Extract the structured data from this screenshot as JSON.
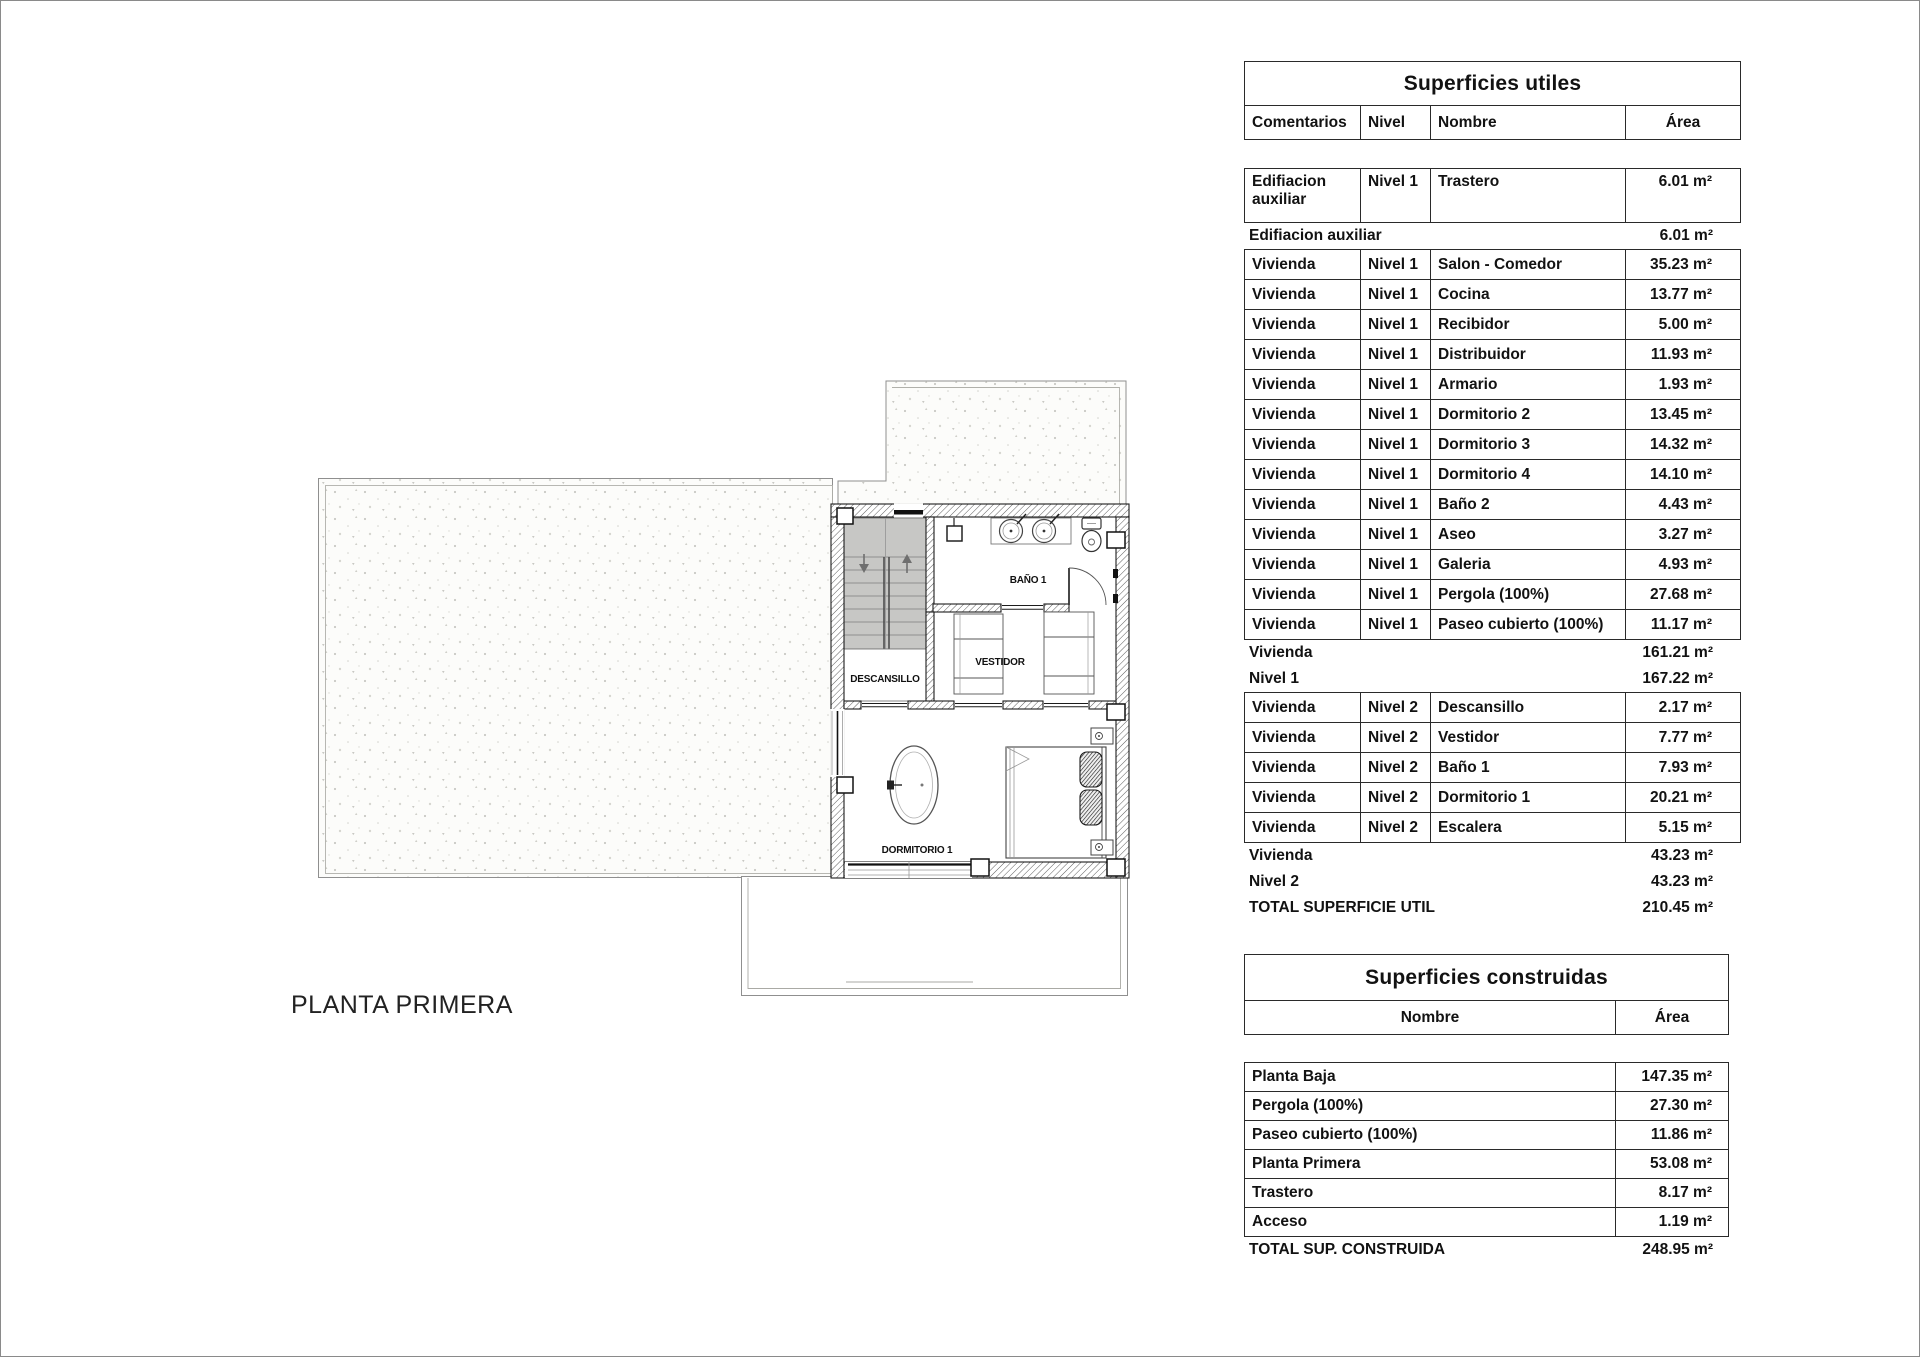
{
  "plan": {
    "caption": "PLANTA PRIMERA",
    "labels": {
      "landing": "DESCANSILLO",
      "dressing": "VESTIDOR",
      "bathroom": "BAÑO 1",
      "bedroom": "DORMITORIO 1"
    },
    "icons": {
      "stairs_down": "down-arrow",
      "stairs_up": "up-arrow"
    }
  },
  "tables": {
    "utiles": {
      "title": "Superficies utiles",
      "headers": [
        "Comentarios",
        "Nivel",
        "Nombre",
        "Área"
      ],
      "rows": [
        {
          "type": "data",
          "tall": true,
          "comentarios": "Edifiacion auxiliar",
          "nivel": "Nivel 1",
          "nombre": "Trastero",
          "area": "6.01 m²"
        },
        {
          "type": "subtotal",
          "label": "Edifiacion auxiliar",
          "area": "6.01 m²"
        },
        {
          "type": "data",
          "comentarios": "Vivienda",
          "nivel": "Nivel 1",
          "nombre": "Salon - Comedor",
          "area": "35.23 m²"
        },
        {
          "type": "data",
          "comentarios": "Vivienda",
          "nivel": "Nivel 1",
          "nombre": "Cocina",
          "area": "13.77 m²"
        },
        {
          "type": "data",
          "comentarios": "Vivienda",
          "nivel": "Nivel 1",
          "nombre": "Recibidor",
          "area": "5.00 m²"
        },
        {
          "type": "data",
          "comentarios": "Vivienda",
          "nivel": "Nivel 1",
          "nombre": "Distribuidor",
          "area": "11.93 m²"
        },
        {
          "type": "data",
          "comentarios": "Vivienda",
          "nivel": "Nivel 1",
          "nombre": "Armario",
          "area": "1.93 m²"
        },
        {
          "type": "data",
          "comentarios": "Vivienda",
          "nivel": "Nivel 1",
          "nombre": "Dormitorio 2",
          "area": "13.45 m²"
        },
        {
          "type": "data",
          "comentarios": "Vivienda",
          "nivel": "Nivel 1",
          "nombre": "Dormitorio 3",
          "area": "14.32 m²"
        },
        {
          "type": "data",
          "comentarios": "Vivienda",
          "nivel": "Nivel 1",
          "nombre": "Dormitorio 4",
          "area": "14.10 m²"
        },
        {
          "type": "data",
          "comentarios": "Vivienda",
          "nivel": "Nivel 1",
          "nombre": "Baño 2",
          "area": "4.43 m²"
        },
        {
          "type": "data",
          "comentarios": "Vivienda",
          "nivel": "Nivel 1",
          "nombre": "Aseo",
          "area": "3.27 m²"
        },
        {
          "type": "data",
          "comentarios": "Vivienda",
          "nivel": "Nivel 1",
          "nombre": "Galeria",
          "area": "4.93 m²"
        },
        {
          "type": "data",
          "comentarios": "Vivienda",
          "nivel": "Nivel 1",
          "nombre": "Pergola (100%)",
          "area": "27.68 m²"
        },
        {
          "type": "data",
          "comentarios": "Vivienda",
          "nivel": "Nivel 1",
          "nombre": "Paseo cubierto (100%)",
          "area": "11.17 m²"
        },
        {
          "type": "subtotal",
          "label": "Vivienda",
          "area": "161.21 m²"
        },
        {
          "type": "subtotal",
          "label": "Nivel 1",
          "area": "167.22 m²"
        },
        {
          "type": "data",
          "comentarios": "Vivienda",
          "nivel": "Nivel 2",
          "nombre": "Descansillo",
          "area": "2.17 m²"
        },
        {
          "type": "data",
          "comentarios": "Vivienda",
          "nivel": "Nivel 2",
          "nombre": "Vestidor",
          "area": "7.77 m²"
        },
        {
          "type": "data",
          "comentarios": "Vivienda",
          "nivel": "Nivel 2",
          "nombre": "Baño 1",
          "area": "7.93 m²"
        },
        {
          "type": "data",
          "comentarios": "Vivienda",
          "nivel": "Nivel 2",
          "nombre": "Dormitorio 1",
          "area": "20.21 m²"
        },
        {
          "type": "data",
          "comentarios": "Vivienda",
          "nivel": "Nivel 2",
          "nombre": "Escalera",
          "area": "5.15 m²"
        },
        {
          "type": "subtotal",
          "label": "Vivienda",
          "area": "43.23 m²"
        },
        {
          "type": "subtotal",
          "label": "Nivel 2",
          "area": "43.23 m²"
        },
        {
          "type": "total",
          "label": "TOTAL SUPERFICIE UTIL",
          "area": "210.45 m²"
        }
      ]
    },
    "construidas": {
      "title": "Superficies construidas",
      "headers": [
        "Nombre",
        "Área"
      ],
      "rows": [
        {
          "type": "data",
          "nombre": "Planta Baja",
          "area": "147.35 m²"
        },
        {
          "type": "data",
          "nombre": "Pergola (100%)",
          "area": "27.30 m²"
        },
        {
          "type": "data",
          "nombre": "Paseo cubierto (100%)",
          "area": "11.86 m²"
        },
        {
          "type": "data",
          "nombre": "Planta Primera",
          "area": "53.08 m²"
        },
        {
          "type": "data",
          "nombre": "Trastero",
          "area": "8.17 m²"
        },
        {
          "type": "data",
          "nombre": "Acceso",
          "area": "1.19 m²"
        },
        {
          "type": "total",
          "label": "TOTAL SUP. CONSTRUIDA",
          "area": "248.95 m²"
        }
      ]
    }
  }
}
